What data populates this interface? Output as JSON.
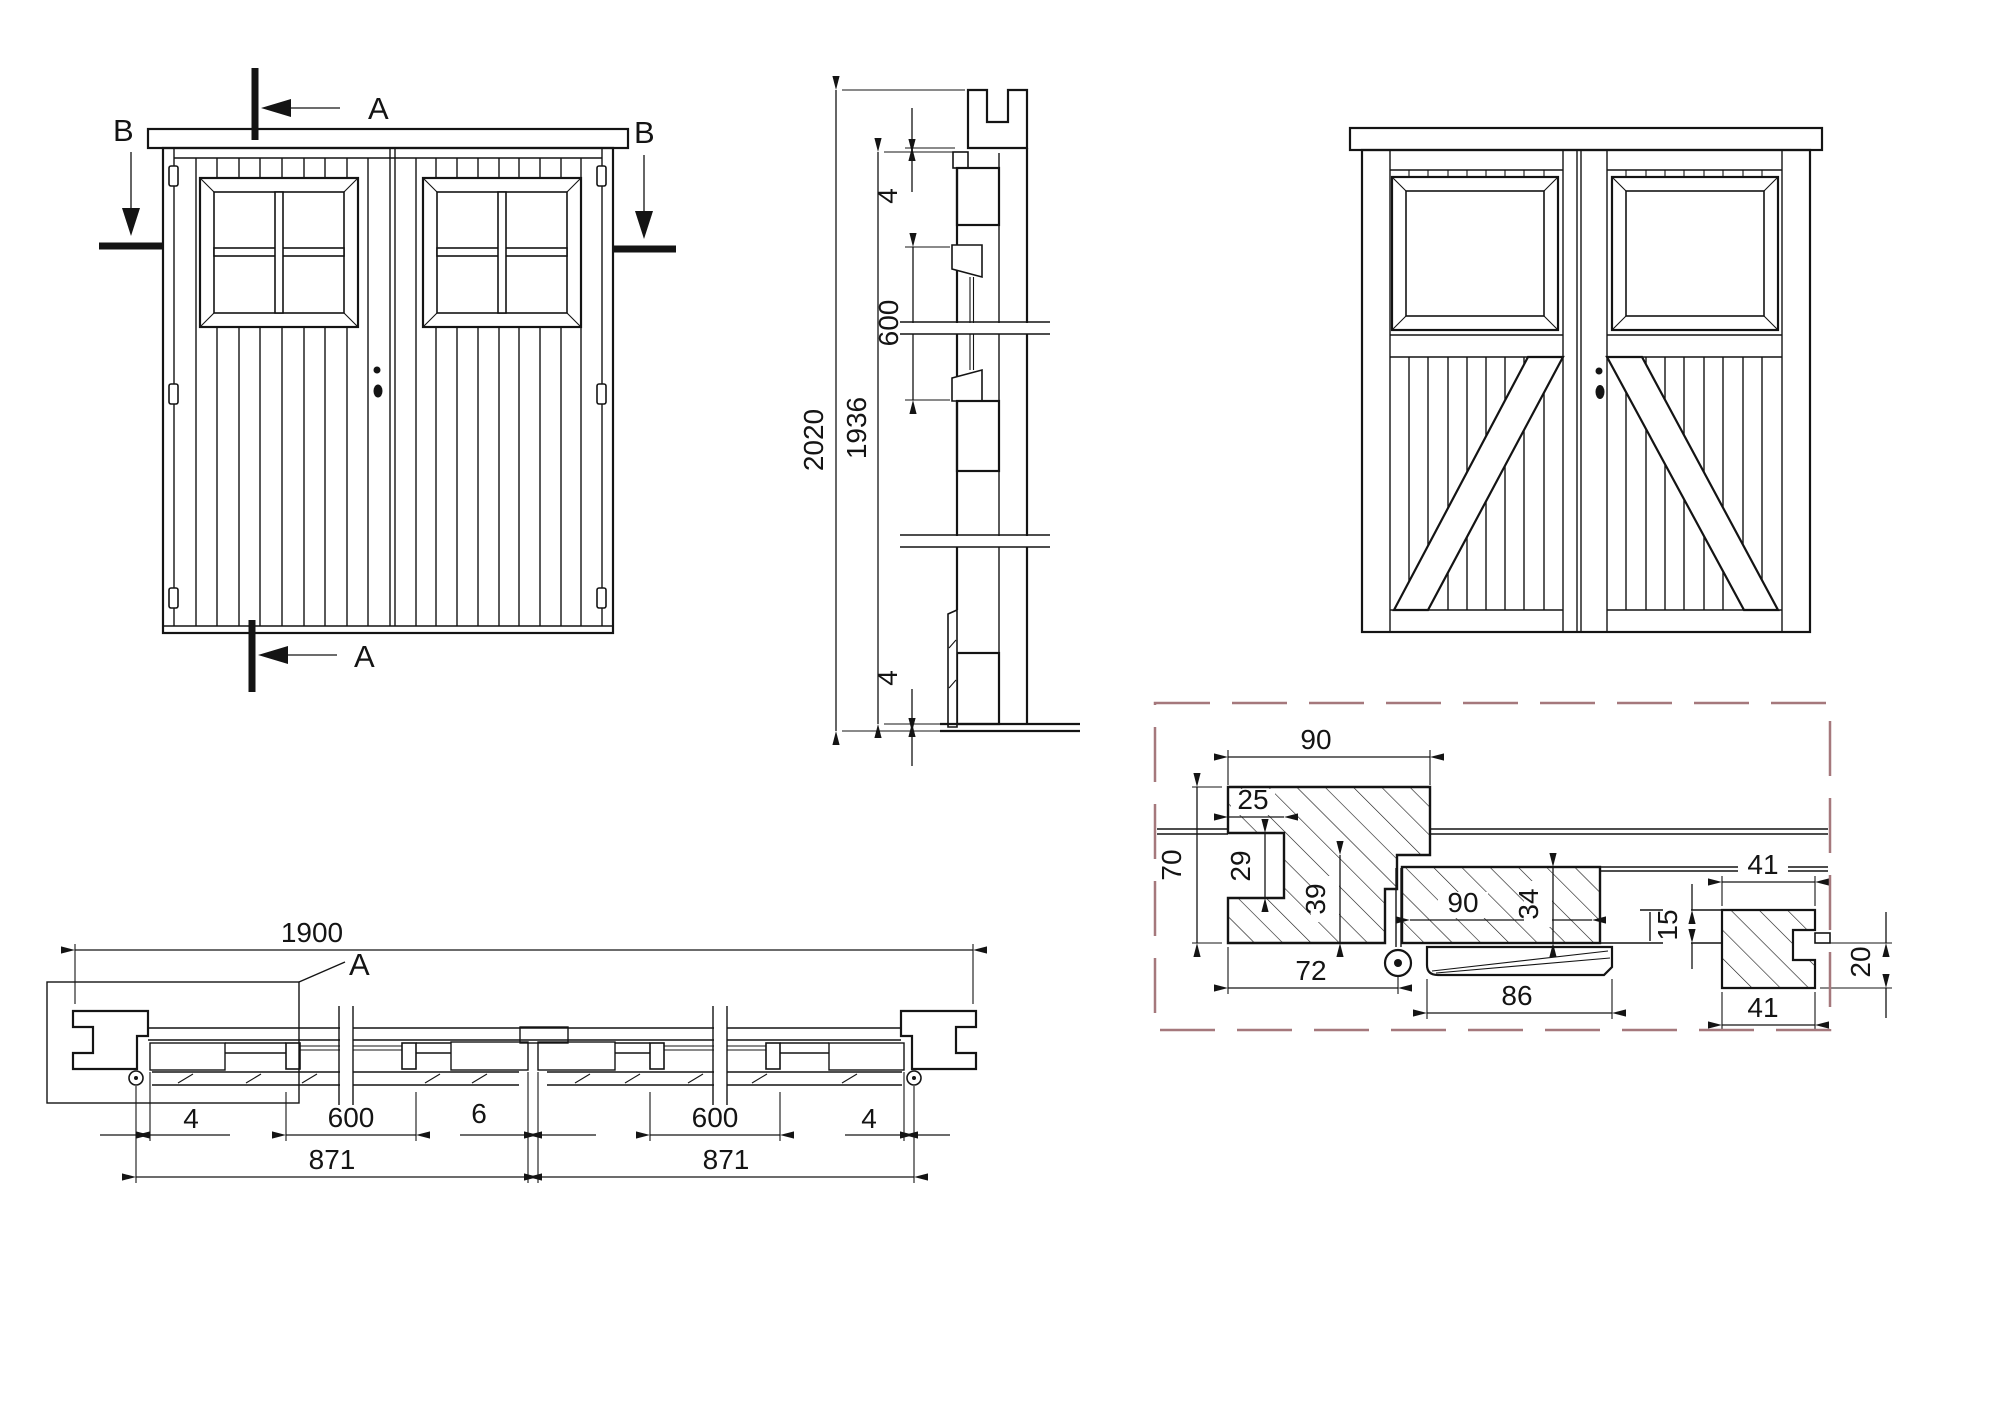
{
  "page": {
    "background": "#ffffff",
    "line_color": "#141414",
    "detail_border_color": "#a5787c"
  },
  "front_elevation": {
    "section_marker_a_top": {
      "label": "A"
    },
    "section_marker_a_bottom": {
      "label": "A"
    },
    "section_marker_b_left": {
      "label": "B"
    },
    "section_marker_b_right": {
      "label": "B"
    }
  },
  "vertical_section": {
    "dims": {
      "overall_height": "2020",
      "leaf_height": "1936",
      "top_gap": "4",
      "window_height": "600",
      "bottom_gap": "4"
    }
  },
  "horizontal_section": {
    "dims": {
      "overall_width": "1900",
      "hinge_gap_left": "4",
      "window_width_left": "600",
      "center_gap": "6",
      "window_width_right": "600",
      "hinge_gap_right": "4",
      "leaf_width_left": "871",
      "leaf_width_right": "871"
    },
    "detail_callout": {
      "label": "A"
    }
  },
  "detail_a": {
    "dims": {
      "frame_depth": "90",
      "groove_width": "25",
      "groove_height": "29",
      "frame_width": "70",
      "rebate_depth": "39",
      "stile_width": "90",
      "leaf_thickness": "34",
      "cladding_board_top": "41",
      "plank_thickness": "15",
      "frame_face_to_hinge": "72",
      "weatherboard_width": "86",
      "cladding_thickness": "20",
      "cladding_board_bottom": "41"
    }
  }
}
